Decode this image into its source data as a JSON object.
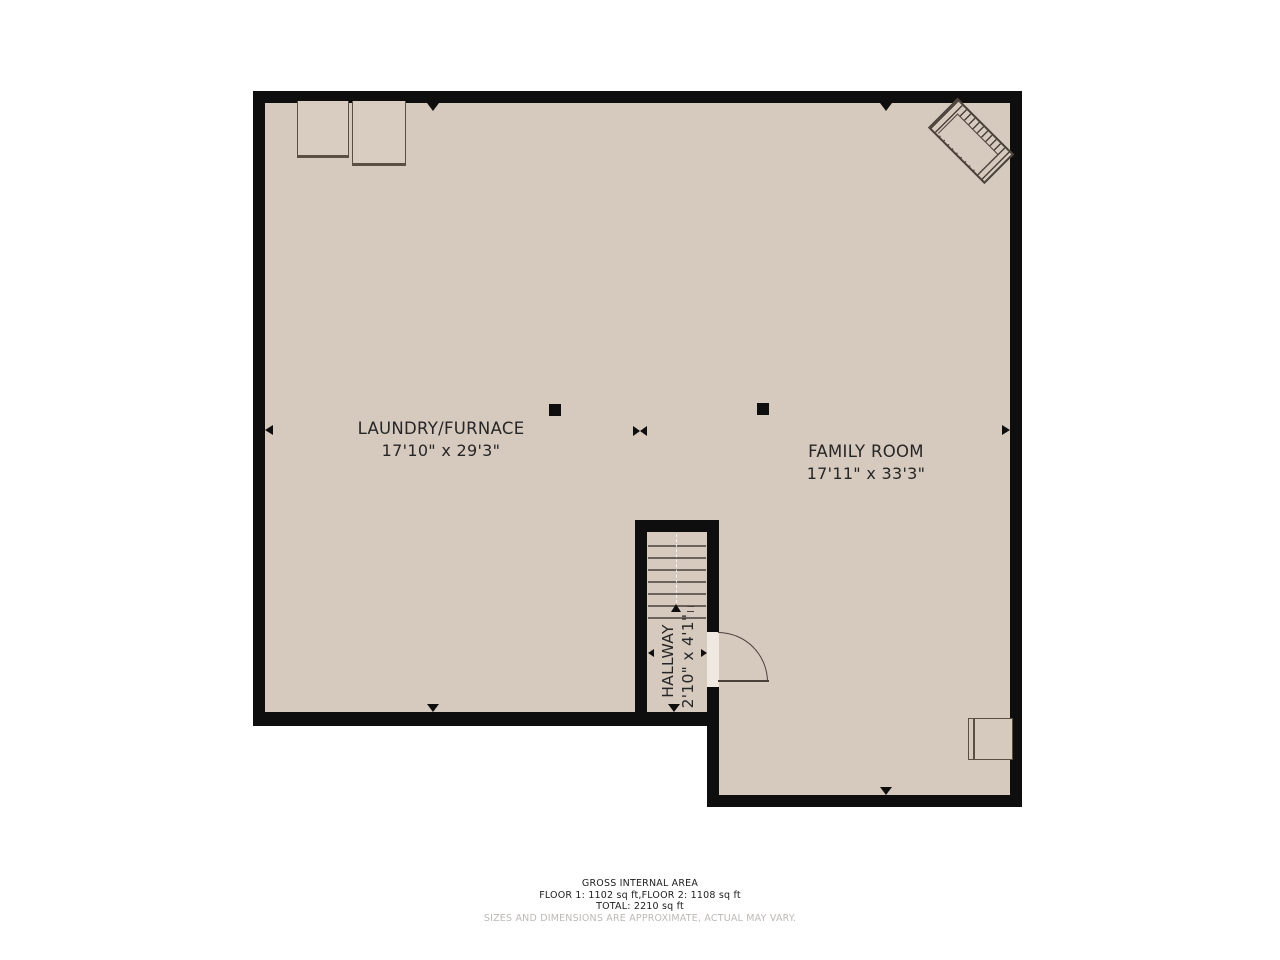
{
  "colors": {
    "floor": "#d6c9be",
    "floorLight": "#f0e9e1",
    "wall": "#0e0e0e",
    "line": "#4a423a",
    "text": "#222222",
    "muted": "#bcb9b6",
    "bg": "#ffffff"
  },
  "rooms": [
    {
      "name": "LAUNDRY/FURNACE",
      "dims": "17'10\" x 29'3\""
    },
    {
      "name": "FAMILY ROOM",
      "dims": "17'11\" x 33'3\""
    },
    {
      "name": "HALLWAY",
      "dims": "2'10\" x 4'1\""
    }
  ],
  "stairs": {
    "treads": 7
  },
  "footer": {
    "line1": "GROSS INTERNAL AREA",
    "line2": "FLOOR 1: 1102 sq ft,FLOOR 2: 1108 sq ft",
    "line3": "TOTAL: 2210 sq ft",
    "disclaimer": "SIZES AND DIMENSIONS ARE APPROXIMATE, ACTUAL MAY VARY."
  }
}
